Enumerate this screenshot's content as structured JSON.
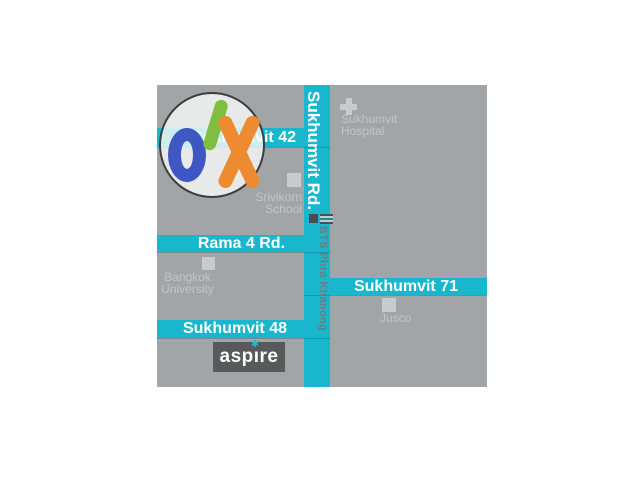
{
  "colors": {
    "page_bg": "#ffffff",
    "map_bg": "#a2a5a7",
    "road_teal": "#19b7cd",
    "road_label": "#ffffff",
    "landmark_box": "#c8cbcc",
    "landmark_text": "#c0c4c5",
    "bts_text": "#707b80",
    "aspire_bg": "#57595b",
    "aspire_text": "#ffffff",
    "aspire_star": "#2bb5c9",
    "olx_o_blue": "#3f57c3",
    "olx_l_green": "#7fbe3e",
    "olx_x_orange": "#ee8a2f",
    "watermark_circle_border": "#3d3d3d"
  },
  "map": {
    "roads": {
      "sukhumvit_rd": "Sukhumvit Rd.",
      "sukhumvit_42": "Sukhumvit 42",
      "rama_4": "Rama 4 Rd.",
      "sukhumvit_48": "Sukhumvit 48",
      "sukhumvit_71": "Sukhumvit 71"
    },
    "transit": {
      "bts_station": "BTS Phra Khanong"
    },
    "landmarks": {
      "hospital": {
        "line1": "Sukhumvit",
        "line2": "Hospital"
      },
      "school": {
        "line1": "Srivikorn",
        "line2": "School"
      },
      "university": {
        "line1": "Bangkok",
        "line2": "University"
      },
      "store": {
        "line1": "Jusco"
      }
    },
    "brands": {
      "aspire": {
        "left": "asp",
        "i": "ı",
        "right": "re",
        "star": "✱"
      },
      "olx": {
        "o": "o",
        "l": "l",
        "x": "x"
      }
    }
  }
}
